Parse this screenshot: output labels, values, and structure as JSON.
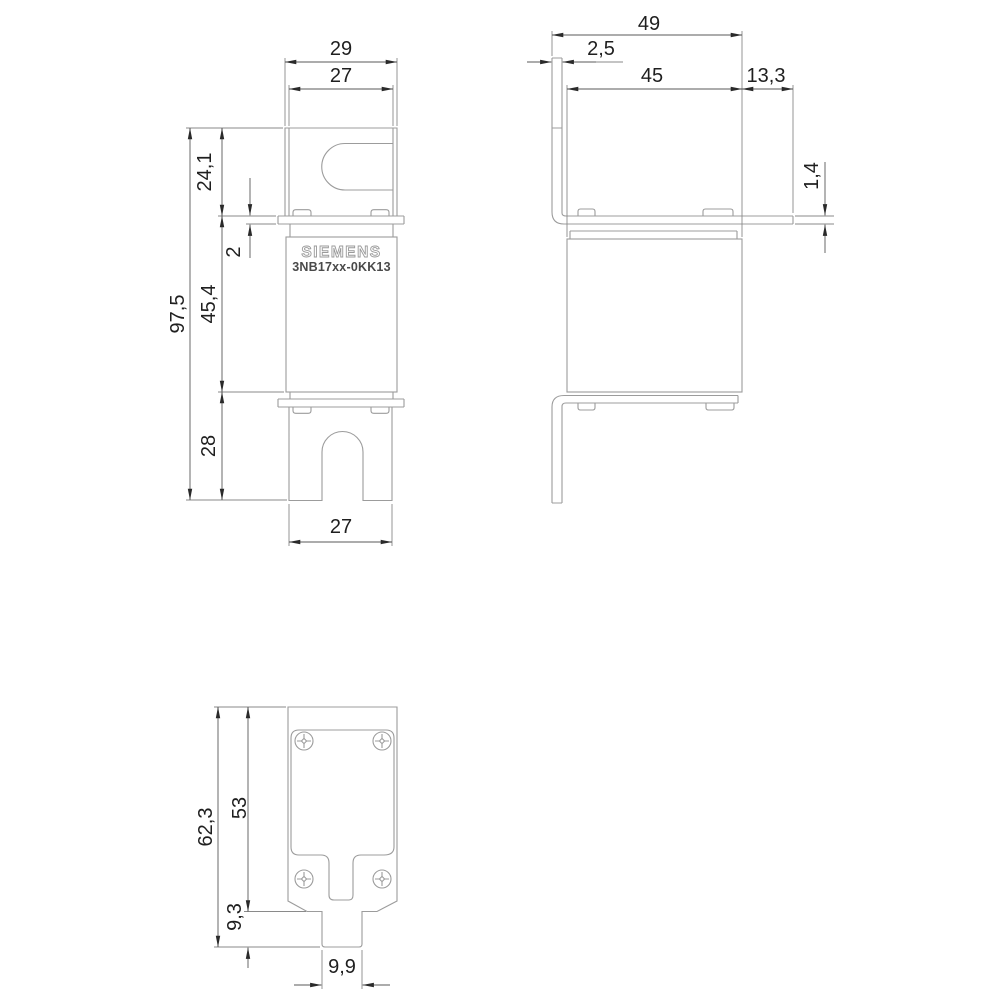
{
  "drawing": {
    "background_color": "#ffffff",
    "geometry_line_color": "#9c9c9c",
    "dimension_line_color": "#8a8a8a",
    "text_color": "#1f1f1f",
    "product_label": {
      "brand": "SIEMENS",
      "part_number": "3NB17xx-0KK13"
    },
    "front_view": {
      "blade_outer_width": "29",
      "blade_inner_width": "27",
      "top_blade_height": "24,1",
      "foot_plate_thickness": "2",
      "overall_height": "97,5",
      "body_height": "45,4",
      "bottom_blade_height": "28",
      "bottom_blade_width": "27"
    },
    "side_view": {
      "overall_depth": "49",
      "blade_plate_thickness": "2,5",
      "body_depth": "45",
      "blade_overhang": "13,3",
      "foot_plate_thickness": "1,4"
    },
    "bottom_view": {
      "overall_length": "62,3",
      "plate_length": "53",
      "tab_length": "9,3",
      "tab_width": "9,9"
    }
  }
}
